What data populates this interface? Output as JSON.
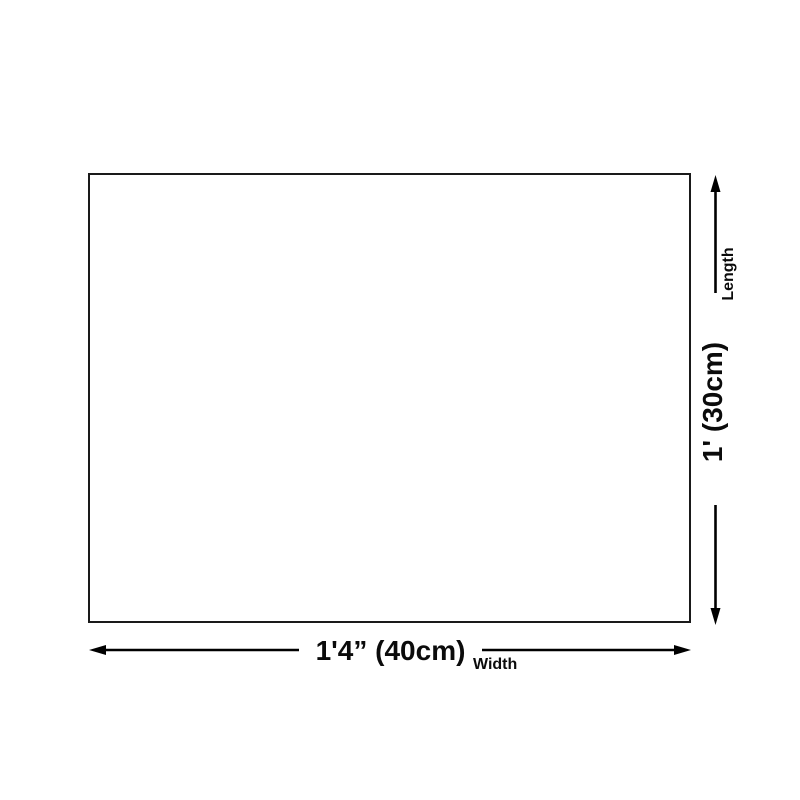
{
  "diagram": {
    "type": "product-dimension-diagram",
    "shape": "rectangle",
    "colors": {
      "background": "#ffffff",
      "outline": "#1a1a1a",
      "dimension_lines": "#000000",
      "text": "#0b0b0b"
    },
    "width_dim": {
      "value": "1'4” (40cm)",
      "label": "Width"
    },
    "length_dim": {
      "value": "1' (30cm)",
      "label": "Length"
    }
  }
}
